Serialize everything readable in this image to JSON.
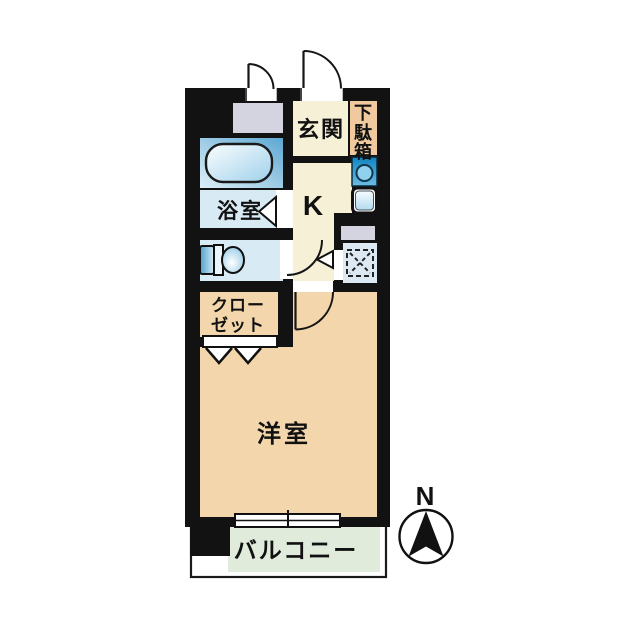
{
  "floorplan": {
    "labels": {
      "entrance": "玄関",
      "shoe_cabinet_chars": [
        "下",
        "駄",
        "箱"
      ],
      "kitchen": "K",
      "bathroom": "浴室",
      "closet_line1": "クロー",
      "closet_line2": "ゼット",
      "western_room": "洋室",
      "balcony": "バルコニー",
      "compass_north": "N"
    },
    "colors": {
      "wall": "#121212",
      "cream": "#f5f0d6",
      "tan": "#f3d6ab",
      "peach": "#f0ca9e",
      "light_blue": "#d8ebf5",
      "pale_blue": "#dde9f2",
      "gray": "#d3d4e0",
      "green": "#e0ebdc",
      "white": "#ffffff"
    }
  }
}
